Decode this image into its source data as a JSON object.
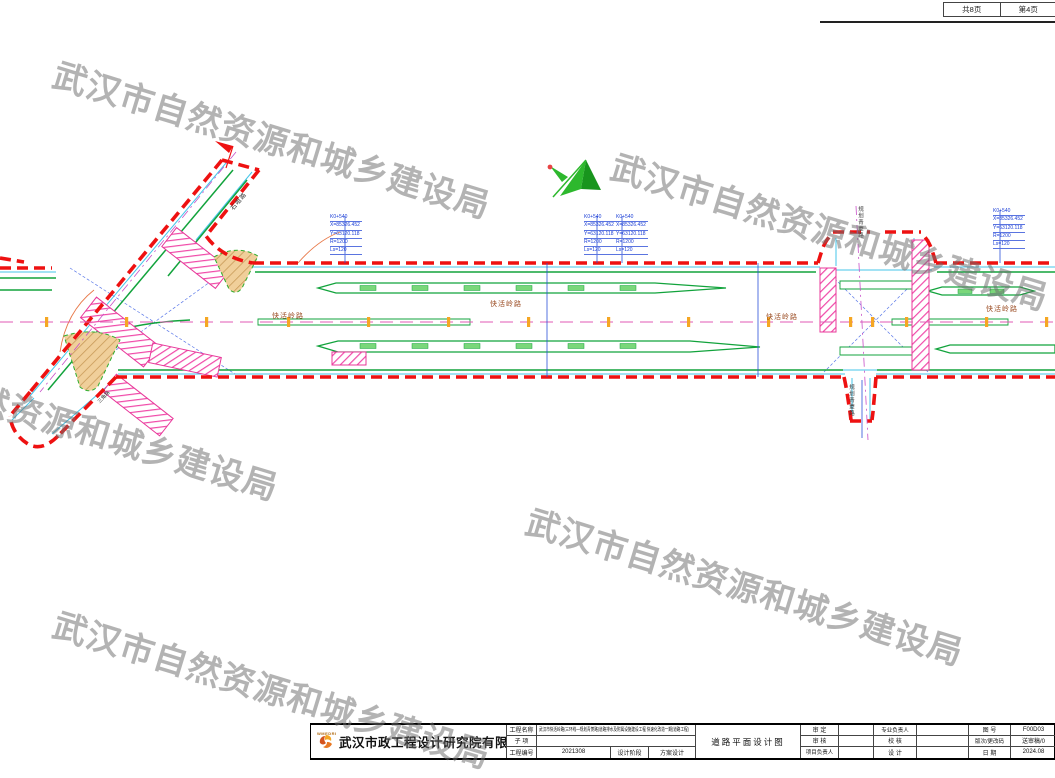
{
  "page_header": {
    "total_pages": "共8页",
    "current_page": "第4页"
  },
  "watermark": {
    "text": "武汉市自然资源和城乡建设局",
    "color": "#6e6e6e"
  },
  "drawing": {
    "road_name_label": "快活岭路",
    "diagonal_road_label": "石咀路",
    "planned_road_label": "规划青菱路",
    "branch_road_label": "三角路",
    "callout_lines": [
      "K0+540",
      "X=85326.452",
      "Y=63120.118",
      "R=1200",
      "Ls=120"
    ],
    "colors": {
      "boundary_red": "#ee1111",
      "lane_green": "#12a33c",
      "curb_cyan": "#45c6ea",
      "crosswalk_pink": "#e8389a",
      "island_tan": "#f0cf9a",
      "station_orange": "#f5a623",
      "annotation_blue": "#1b3ed6"
    }
  },
  "title_block": {
    "company_name": "武汉市政工程设计研究院有限责任公司",
    "logo_caption": "WMEDRI",
    "project_name_label": "工程名称",
    "project_name": "武汉市快活岭路(三环线—规划青菱路)道路排水及附属设施建设工程 快速化改造一期(道路工程)",
    "subitem_label": "子  项",
    "subitem_value": "",
    "project_no_label": "工程编号",
    "project_no": "2021308",
    "stage_label": "设计阶段",
    "stage": "方案设计",
    "drawing_title": "道路平面设计图",
    "approved_label": "审  定",
    "reviewed_label": "审  核",
    "project_leader_label": "项目负责人",
    "discipline_leader_label": "专业负责人",
    "checked_label": "校  核",
    "designed_label": "设  计",
    "drawing_no_label": "图  号",
    "drawing_no": "F00D03",
    "revision_label": "版次/更改码",
    "revision": "送审稿/0",
    "date_label": "日  期",
    "date": "2024.08"
  }
}
